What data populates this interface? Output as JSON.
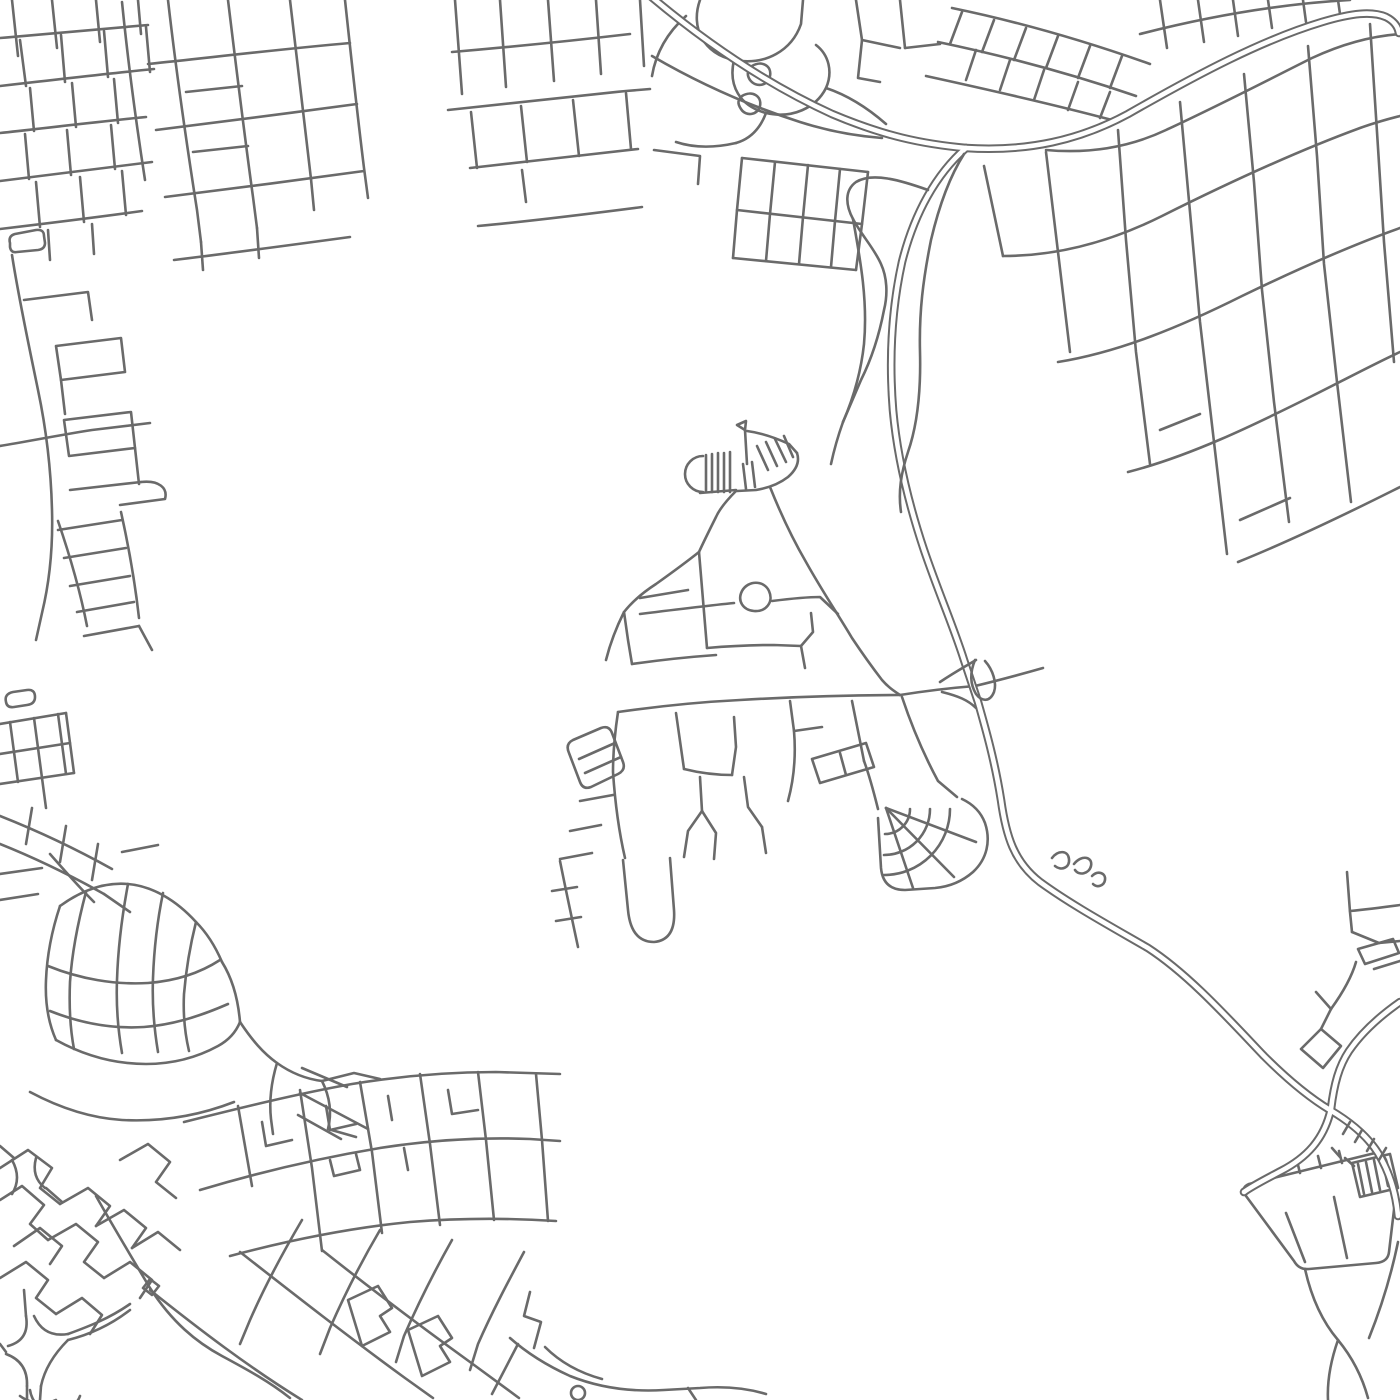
{
  "map": {
    "background": "#ffffff",
    "road_color": "#6a6a6a",
    "inner_color": "#ffffff",
    "canvas": {
      "width": 1400,
      "height": 1400
    },
    "stroke": {
      "minor": 2.6,
      "casing": 8.6,
      "inner": 4.6
    },
    "groups": [
      {
        "name": "top-left-grid",
        "style": "single",
        "paths": [
          "M12,0 L18,56",
          "M52,0 L57,48",
          "M96,0 L100,42",
          "M138,0 L141,34",
          "M0,38 C50,34 100,29 148,25",
          "M0,86 C52,80 104,74 154,69",
          "M0,133 C46,128 96,122 146,117",
          "M0,181 C50,175 102,168 152,162",
          "M0,229 C42,224 92,218 142,211",
          "M20,40 L26,86",
          "M61,35 L65,82",
          "M104,31 L108,77",
          "M146,27 L150,72",
          "M30,88 L34,131",
          "M72,83 L76,127",
          "M114,79 L118,123",
          "M25,134 L29,179",
          "M67,130 L71,175",
          "M111,125 L115,169",
          "M36,182 L40,227",
          "M80,177 L84,222",
          "M122,171 L126,215",
          "M48,230 L50,260",
          "M92,224 L94,254",
          "M168,0 C176,70 186,140 197,210 L201,242",
          "M122,2 C128,62 136,122 145,180",
          "M228,0 C236,66 244,132 253,197 L257,228",
          "M290,0 C297,60 304,120 311,179",
          "M345,0 C351,56 357,112 364,168 L368,198",
          "M148,64 C215,57 282,49 350,43",
          "M156,130 C222,122 290,113 357,104",
          "M165,197 C231,189 298,180 364,171",
          "M174,260 C232,253 291,245 350,237",
          "M186,92 L242,86",
          "M193,152 L248,146",
          "M311,179 L314,210",
          "M257,228 L259,258",
          "M201,242 L203,270",
          "M455,0 L462,94",
          "M500,0 L506,87",
          "M548,0 L554,81",
          "M596,0 L601,74",
          "M640,0 L644,66",
          "M452,52 C510,47 570,41 630,34",
          "M448,110 C506,104 566,97 626,91 L650,89",
          "M470,168 C526,162 582,155 638,149",
          "M478,226 C532,221 588,214 642,207",
          "M471,112 L477,168",
          "M521,106 L527,162",
          "M573,100 L579,156",
          "M626,93 L631,149",
          "M522,170 L526,202",
          "M742,158 L868,172",
          "M737,210 L862,224",
          "M733,258 L856,270",
          "M742,158 L737,210 L733,258",
          "M775,162 L770,214 L766,261",
          "M808,165 L803,217 L799,264",
          "M840,169 L835,221 L831,267",
          "M868,172 L862,224 L856,270",
          "M654,150 L700,156 L698,184"
        ]
      },
      {
        "name": "left-strip",
        "style": "single",
        "paths": [
          "M10,243 Q8,236 15,234 L36,230 Q44,229 44,236 L45,243 Q45,249 38,250 L17,252 Q11,253 10,247 Z",
          "M12,255 C19,300 29,346 38,390 C46,428 51,470 52,510 C53,546 50,580 42,613 L36,640",
          "M24,300 L88,292 L92,320",
          "M56,346 L121,338 L125,372 L61,380 Z",
          "M61,380 L65,414",
          "M64,420 L131,412 L135,448 L69,456 Z",
          "M135,448 L139,484",
          "M70,490 L141,482",
          "M141,482 C159,480 168,488 165,499 L120,505",
          "M0,446 C30,441 60,435 92,430 L150,423",
          "M58,521 C70,556 80,590 87,626",
          "M121,512 C129,548 135,582 139,618",
          "M58,530 L122,520",
          "M64,558 L126,548",
          "M70,586 L130,576",
          "M77,612 L134,602",
          "M84,636 L139,626",
          "M139,626 L152,650",
          "M6,702 Q4,694 13,692 L27,690 Q35,689 35,697 Q35,704 27,705 L14,707 Q7,708 6,702 Z",
          "M0,724 L66,713",
          "M0,754 L70,743",
          "M0,784 L74,773",
          "M10,722 L14,752 L18,782",
          "M34,718 L38,748 L42,778",
          "M58,714 L62,744 L66,774",
          "M66,713 L70,743 L74,773",
          "M42,778 L46,808",
          "M0,816 C38,831 76,849 112,869",
          "M0,844 C35,858 70,875 104,894",
          "M32,808 L26,844",
          "M66,826 L60,862",
          "M98,844 L92,880",
          "M104,894 L130,912",
          "M122,852 L158,845"
        ]
      },
      {
        "name": "top-center-organic",
        "style": "single",
        "paths": [
          "M700,0 C690,28 704,54 734,60 C766,66 792,50 801,24 L803,0",
          "M734,60 C728,86 740,106 766,113 C792,119 816,108 826,88 C833,72 829,55 816,45",
          "M826,88 C850,96 870,110 886,124",
          "M766,113 C760,129 750,139 736,143",
          "M686,16 C668,32 656,52 652,76",
          "M736,143 C714,148 694,148 676,142",
          "M752,66 C762,60 772,66 770,76 C768,86 756,88 750,80 C746,74 748,70 752,66 Z",
          "M742,96 C752,90 762,96 760,106 C758,115 746,117 741,109 C737,103 738,100 742,96 Z",
          "M856,0 L862,40 L900,48",
          "M900,0 L905,48",
          "M862,40 L858,78 L880,82",
          "M905,48 L940,44",
          "M652,56 C700,84 750,106 800,122 C828,131 856,136 882,138"
        ]
      },
      {
        "name": "top-right-grid",
        "style": "single",
        "paths": [
          "M1046,150 C1090,154 1130,147 1166,130 C1222,104 1268,80 1312,58 C1342,44 1372,36 1400,34",
          "M1003,256 C1060,256 1112,241 1162,216 C1232,181 1300,150 1360,128 C1374,123 1388,119 1400,116",
          "M1058,362 C1120,352 1182,326 1242,296 C1300,268 1352,245 1400,228",
          "M1128,472 C1190,456 1252,426 1312,396 C1346,379 1376,363 1400,352",
          "M1238,562 C1290,541 1342,516 1392,491 L1400,487",
          "M984,166 L1003,256",
          "M1046,152 L1058,252 L1070,352",
          "M1118,130 L1126,240 L1136,352 L1150,464",
          "M1180,102 L1190,212 L1200,322 L1214,442 L1227,554",
          "M1244,74 L1254,182 L1262,290 L1274,402 L1289,522",
          "M1308,46 L1317,156 L1324,264 L1337,382 L1351,502",
          "M1370,24 L1377,132 L1384,242 L1394,362",
          "M1240,520 L1290,498",
          "M1160,430 L1200,414",
          "M1160,0 L1167,48",
          "M1198,0 L1204,42",
          "M1233,0 L1238,36",
          "M1268,0 L1272,28",
          "M1303,0 L1306,22",
          "M1338,0 L1340,14",
          "M1140,34 C1210,16 1280,4 1350,0",
          "M952,8 C1020,22 1088,42 1150,64",
          "M938,42 C1005,56 1072,74 1136,96",
          "M926,76 C990,90 1052,104 1112,120",
          "M962,12 L950,44",
          "M994,20 L982,52",
          "M1026,28 L1014,60",
          "M1058,36 L1046,68",
          "M1090,46 L1078,78",
          "M1122,56 L1110,88",
          "M976,50 L966,80",
          "M1010,60 L1000,90",
          "M1044,70 L1034,100",
          "M1078,82 L1068,110",
          "M1110,92 L1100,118"
        ]
      },
      {
        "name": "village",
        "style": "single",
        "paths": [
          "M745,430 L737,425 L746,421 Z",
          "M745,430 L747,464",
          "M703,456 A18,18 0 0 0 703,492",
          "M706,455 L706,492",
          "M712,454 L712,492",
          "M718,453 L718,492",
          "M724,453 L724,492",
          "M730,452 L730,492",
          "M700,493 L736,490",
          "M743,464 L746,489",
          "M752,462 L755,487",
          "M747,431 C762,433 776,438 789,444 L797,453",
          "M797,453 C800,462 796,470 788,477 C779,484 768,488 756,490 L737,491",
          "M757,446 L768,470",
          "M766,442 L777,466",
          "M775,439 L786,462",
          "M784,436 L793,457",
          "M736,491 C727,500 720,508 716,517 C710,529 704,541 699,552",
          "M770,487 C780,512 792,538 806,562 C821,589 837,613 852,638 C862,653 872,667 882,680 C888,687 894,691 900,695",
          "M699,552 C684,564 670,574 656,584 C642,593 632,602 624,612 C616,628 610,644 606,660",
          "M640,598 L688,590",
          "M742,591 C748,580 764,580 769,591 C774,602 766,612 754,611 C743,610 737,601 742,591 Z",
          "M699,552 C701,576 703,600 705,624 L707,648",
          "M624,612 L628,640 L632,664",
          "M632,664 C660,660 688,657 716,655",
          "M640,614 C672,610 704,606 734,603",
          "M772,601 C788,599 804,597 820,597 L838,614",
          "M707,648 C730,646 752,645 774,645 L801,646",
          "M801,646 L813,632 L811,613",
          "M801,646 L805,668",
          "M618,712 C660,706 700,702 740,700 C790,697 845,695 900,695",
          "M900,695 C925,691 950,688 975,686 C1000,680 1022,674 1043,668",
          "M569,753 Q565,744 573,740 L601,728 Q609,725 612,733 L623,762 Q626,770 618,774 L591,787 Q583,790 580,782 Z",
          "M579,759 L615,743",
          "M585,773 L621,757",
          "M618,712 C615,732 613,752 613,772 C615,802 619,832 625,858",
          "M623,860 L628,910 Q631,942 654,942 Q676,940 674,910 L670,858",
          "M580,801 L613,795",
          "M570,831 L601,825",
          "M560,859 L592,853",
          "M560,861 C566,891 572,919 578,947",
          "M552,891 L577,887",
          "M556,921 L581,917",
          "M676,713 L680,741 L684,769",
          "M684,769 C700,773 716,775 732,775",
          "M732,775 L736,747 L734,717",
          "M700,777 L702,811",
          "M702,811 L688,831 L684,857",
          "M702,811 L716,833 L714,859",
          "M744,777 L748,807 L762,827",
          "M762,827 L766,853",
          "M790,701 L794,731 C796,755 794,779 788,801",
          "M794,731 L822,727",
          "M812,759 L866,743 L874,767 L820,783 Z",
          "M840,753 L846,775",
          "M852,701 L858,731 L864,761",
          "M864,761 C870,777 874,793 878,809",
          "M902,697 C912,727 924,755 938,781 L957,797",
          "M962,799 Q979,807 985,823 C991,841 987,859 973,872 Q957,886 935,888 L905,890 Q883,890 881,868 L878,818",
          "M910,809 A25,25 0 0 1 885,834",
          "M930,809 A46,46 0 0 1 884,855",
          "M950,809 A66,66 0 0 1 884,875",
          "M886,808 L976,842",
          "M886,808 L954,877",
          "M886,808 L913,888"
        ]
      },
      {
        "name": "bottom-left-town",
        "style": "single",
        "paths": [
          "M50,854 C64,870 78,886 94,902",
          "M0,874 L42,868",
          "M0,900 L38,894",
          "M60,906 C82,890 105,882 128,884 C152,886 176,900 196,922 C208,934 216,948 222,962",
          "M60,906 C52,930 47,955 46,980 C45,1002 48,1022 56,1040",
          "M56,1040 C85,1056 115,1064 146,1064 C172,1064 196,1058 218,1046 C229,1040 236,1032 240,1022",
          "M222,962 C232,978 238,998 240,1022",
          "M48,966 C80,979 115,985 148,983 C175,981 200,973 220,960",
          "M50,1011 C80,1023 112,1029 144,1027 C170,1025 196,1018 228,1004",
          "M86,892 C78,922 72,952 70,982 C69,1006 70,1028 74,1049",
          "M128,884 C122,916 118,948 117,980 C116,1006 118,1030 122,1053",
          "M163,893 C157,922 154,950 153,978 C152,1004 154,1028 158,1052",
          "M196,922 C190,946 186,970 184,994 C183,1014 185,1034 189,1051",
          "M240,1022 C252,1040 263,1053 277,1063 C291,1073 306,1079 322,1081",
          "M322,1081 L354,1073 L380,1079",
          "M322,1081 C330,1097 332,1113 328,1129 L356,1137",
          "M277,1063 C271,1083 269,1101 271,1119 L273,1134",
          "M302,1068 L347,1087",
          "M300,1093 L368,1129",
          "M298,1115 L341,1139",
          "M0,1168 L28,1150 L52,1168 L40,1188 L60,1204",
          "M0,1200 L22,1186 L44,1205 L30,1224 L48,1240",
          "M14,1246 L40,1228 L62,1246 L50,1264",
          "M0,1278 L26,1262 L48,1280 L36,1298 L56,1314",
          "M60,1204 L88,1188 L110,1206 L96,1226",
          "M48,1240 L76,1224 L98,1242 L84,1262 L104,1278",
          "M56,1314 L82,1298 L102,1315 L90,1334",
          "M96,1226 L124,1210 L146,1228 L132,1248",
          "M104,1278 L130,1262 L152,1280 L140,1298",
          "M120,1160 L148,1144 L170,1162 L156,1182 L176,1198",
          "M132,1248 L158,1232 L180,1250",
          "M12,1160 Q22,1178 12,1194",
          "M36,1158 Q31,1177 45,1188",
          "M0,1146 L14,1158",
          "M46,1188 L62,1202",
          "M30,1092 C60,1108 90,1118 122,1120 C160,1122 198,1116 234,1102",
          "M184,1122 C240,1108 296,1094 352,1084 C400,1076 448,1072 496,1072 L560,1074",
          "M200,1190 C260,1172 320,1158 380,1148 C430,1140 480,1137 530,1139 L560,1141",
          "M230,1256 C290,1240 350,1228 410,1222 C460,1218 510,1218 556,1221",
          "M238,1106 L252,1186",
          "M300,1090 L312,1168 L322,1251",
          "M360,1082 L372,1152 L382,1233",
          "M420,1074 L430,1144 L440,1225",
          "M478,1072 L486,1140 L494,1220",
          "M536,1074 L542,1140 L548,1221",
          "M262,1122 L266,1146 L292,1140",
          "M326,1106 L330,1130 L356,1124",
          "M388,1096 L392,1120",
          "M448,1090 L452,1114 L478,1110",
          "M330,1160 L334,1176 L360,1170 L356,1154",
          "M404,1148 L408,1170",
          "M96,1196 C114,1228 132,1258 150,1288 C172,1322 196,1342 222,1356 C248,1370 270,1382 290,1398",
          "M150,1290 C200,1330 250,1368 302,1400",
          "M240,1252 C295,1295 350,1338 405,1378 L433,1398",
          "M322,1250 C370,1288 420,1326 470,1362 L519,1398",
          "M302,1220 C282,1254 264,1288 250,1320 L240,1344",
          "M380,1230 C360,1264 344,1296 330,1328 L320,1354",
          "M452,1240 C434,1272 418,1304 404,1336 L396,1362",
          "M524,1252 C508,1282 492,1312 478,1344 L470,1370",
          "M348,1300 L378,1286 L392,1308 L380,1316 L390,1332 L362,1346 Z",
          "M408,1330 L438,1316 L452,1338 L440,1346 L450,1362 L422,1376 Z",
          "M143,1288 L150,1279 L159,1286 L152,1295 Z",
          "M26,1316 Q30,1340 8,1346",
          "M34,1316 Q44,1338 68,1334",
          "M6,1354 Q28,1362 27,1386",
          "M68,1340 Q46,1362 41,1386",
          "M24,1290 L26,1316",
          "M0,1344 L6,1352",
          "M27,1386 L27,1400",
          "M41,1386 L40,1400",
          "M68,1334 C90,1326 110,1318 130,1304",
          "M68,1340 C92,1334 112,1324 130,1310",
          "M30,1390 A26,26 0 0 0 80,1396",
          "M20,1396 A36,36 0 0 0 56,1400",
          "M530,1292 L524,1316 L541,1322 L534,1348",
          "M518,1344 L492,1394",
          "M510,1338 C528,1354 548,1366 570,1376 C600,1388 632,1392 664,1390 L700,1388 C724,1386 746,1388 766,1394",
          "M571,1393 A7,7 0 1 0 585,1393 A7,7 0 1 0 571,1393",
          "M545,1347 C560,1362 580,1373 602,1379",
          "M688,1388 L696,1400"
        ]
      },
      {
        "name": "bottom-right-area",
        "style": "single",
        "paths": [
          "M1347,872 L1350,912 L1352,932",
          "M1350,911 C1370,909 1385,907 1400,905",
          "M1352,932 L1379,943 L1400,941",
          "M1358,949 L1393,939 L1399,953 L1365,964 Z",
          "M1374,969 L1400,961",
          "M1301,1049 L1321,1029 L1341,1046 L1323,1068 Z",
          "M1331,1009 C1344,991 1352,976 1356,962",
          "M1321,1029 L1331,1009",
          "M1331,1009 L1316,992",
          "M1246,1196 Q1240,1188 1249,1184 L1371,1154 Q1382,1151 1386,1160 L1396,1193 L1389,1252 Q1388,1262 1376,1263 L1309,1269 Q1299,1270 1294,1261 Z",
          "M1286,1213 L1305,1262",
          "M1334,1197 L1347,1258",
          "M1352,1163 L1390,1154 L1398,1188 L1360,1197 Z",
          "M1358,1164 L1364,1194",
          "M1366,1162 L1372,1192",
          "M1374,1160 L1380,1190",
          "M1382,1158 L1388,1186",
          "M1300,1173 L1297,1161",
          "M1321,1168 L1318,1156",
          "M1342,1163 L1339,1151",
          "M1305,1269 C1311,1296 1321,1320 1338,1340 C1352,1357 1362,1376 1368,1398",
          "M1338,1340 C1331,1360 1327,1380 1328,1400",
          "M1398,1242 C1391,1276 1381,1308 1369,1338"
        ]
      },
      {
        "name": "highway",
        "style": "double",
        "paths": [
          "M648,-6 C700,38 762,82 832,114 C884,136 922,144 966,148",
          "M966,148 C1028,152 1080,140 1128,114 C1198,74 1262,40 1322,22 C1352,13 1372,11 1386,17 C1394,21 1398,27 1399,33",
          "M966,148 C936,174 914,214 902,262 C891,312 889,360 893,410 C897,455 908,502 924,550 C939,594 954,628 964,660 C970,678 974,690 978,702 C986,730 995,762 1001,800 C1006,836 1014,862 1040,882 C1070,904 1110,926 1148,948 C1188,974 1226,1016 1264,1056 C1288,1080 1310,1098 1330,1110 C1352,1123 1368,1137 1378,1153 C1390,1173 1396,1193 1398,1216",
          "M1400,1002 C1380,1016 1362,1032 1349,1051 C1339,1066 1334,1084 1331,1109 C1324,1140 1306,1158 1281,1171 C1266,1179 1252,1186 1244,1192"
        ]
      },
      {
        "name": "ramps-details",
        "style": "single",
        "paths": [
          "M964,154 C950,176 939,206 931,240 C923,280 919,312 920,352 C921,392 917,426 908,452 C901,473 898,492 901,512",
          "M928,190 C900,180 872,172 856,182 C845,190 845,204 853,219 C862,236 874,248 881,264 C887,277 888,294 884,310 C879,336 871,360 861,380 C855,394 849,408 843,422",
          "M853,219 C860,258 868,300 864,344 C861,372 853,399 843,422",
          "M843,422 C838,436 834,450 831,464",
          "M940,682 C955,672 966,666 976,660",
          "M942,692 C958,696 968,700 976,708",
          "M975,660 C970,672 970,684 976,694 C982,702 990,702 994,692 C997,683 993,670 985,661",
          "M1052,858 C1058,850 1068,850 1069,859 C1070,868 1061,871 1055,866",
          "M1074,864 C1082,854 1093,857 1091,866 C1089,874 1079,876 1075,870",
          "M1092,876 C1098,870 1106,873 1105,880 C1104,886 1097,888 1093,884",
          "M1350,1122 L1343,1134",
          "M1362,1130 L1355,1142",
          "M1374,1139 L1367,1151",
          "M1386,1148 L1379,1160",
          "M1345,1158 L1354,1166",
          "M1332,1148 L1340,1157"
        ]
      }
    ]
  }
}
